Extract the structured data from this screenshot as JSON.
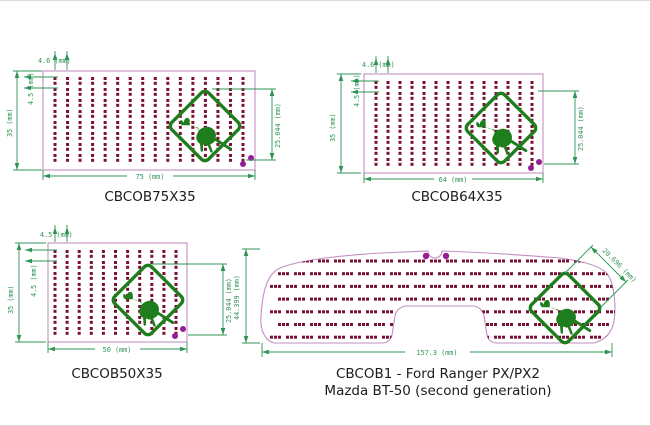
{
  "colors": {
    "dimension_green": "#2e9455",
    "board_outline_pink": "#c28fc2",
    "pad_maroon": "#7a1133",
    "sign_green": "#1e7e1e",
    "hole_purple": "#951e95",
    "title_ink": "#1c1c1c",
    "background": "#ffffff"
  },
  "icons": {
    "sign": "kangaroo-warning-sign-icon",
    "hole": "mounting-hole"
  },
  "panels": [
    {
      "id": "CBCOB75X35",
      "title": "CBCOB75X35",
      "dims": {
        "width": "75 (mm)",
        "height": "35 (mm)",
        "col_pitch": "4.6 (mm)",
        "row_pitch": "4.5 (mm)",
        "sign_size": "25.044 (mm)"
      }
    },
    {
      "id": "CBCOB64X35",
      "title": "CBCOB64X35",
      "dims": {
        "width": "64 (mm)",
        "height": "35 (mm)",
        "col_pitch": "4.6 (mm)",
        "row_pitch": "4.5 (mm)",
        "sign_size": "25.044 (mm)"
      }
    },
    {
      "id": "CBCOB50X35",
      "title": "CBCOB50X35",
      "dims": {
        "width": "50 (mm)",
        "height": "35 (mm)",
        "col_pitch": "4.5 (mm)",
        "row_pitch": "4.5 (mm)",
        "sign_size": "25.044 (mm)"
      }
    },
    {
      "id": "CBCOB1",
      "title_line1": "CBCOB1 - Ford Ranger PX/PX2",
      "title_line2": "Mazda BT-50 (second generation)",
      "dims": {
        "width": "157.3 (mm)",
        "height": "44.399 (mm)",
        "sign_size": "20.696 (mm)"
      }
    }
  ]
}
